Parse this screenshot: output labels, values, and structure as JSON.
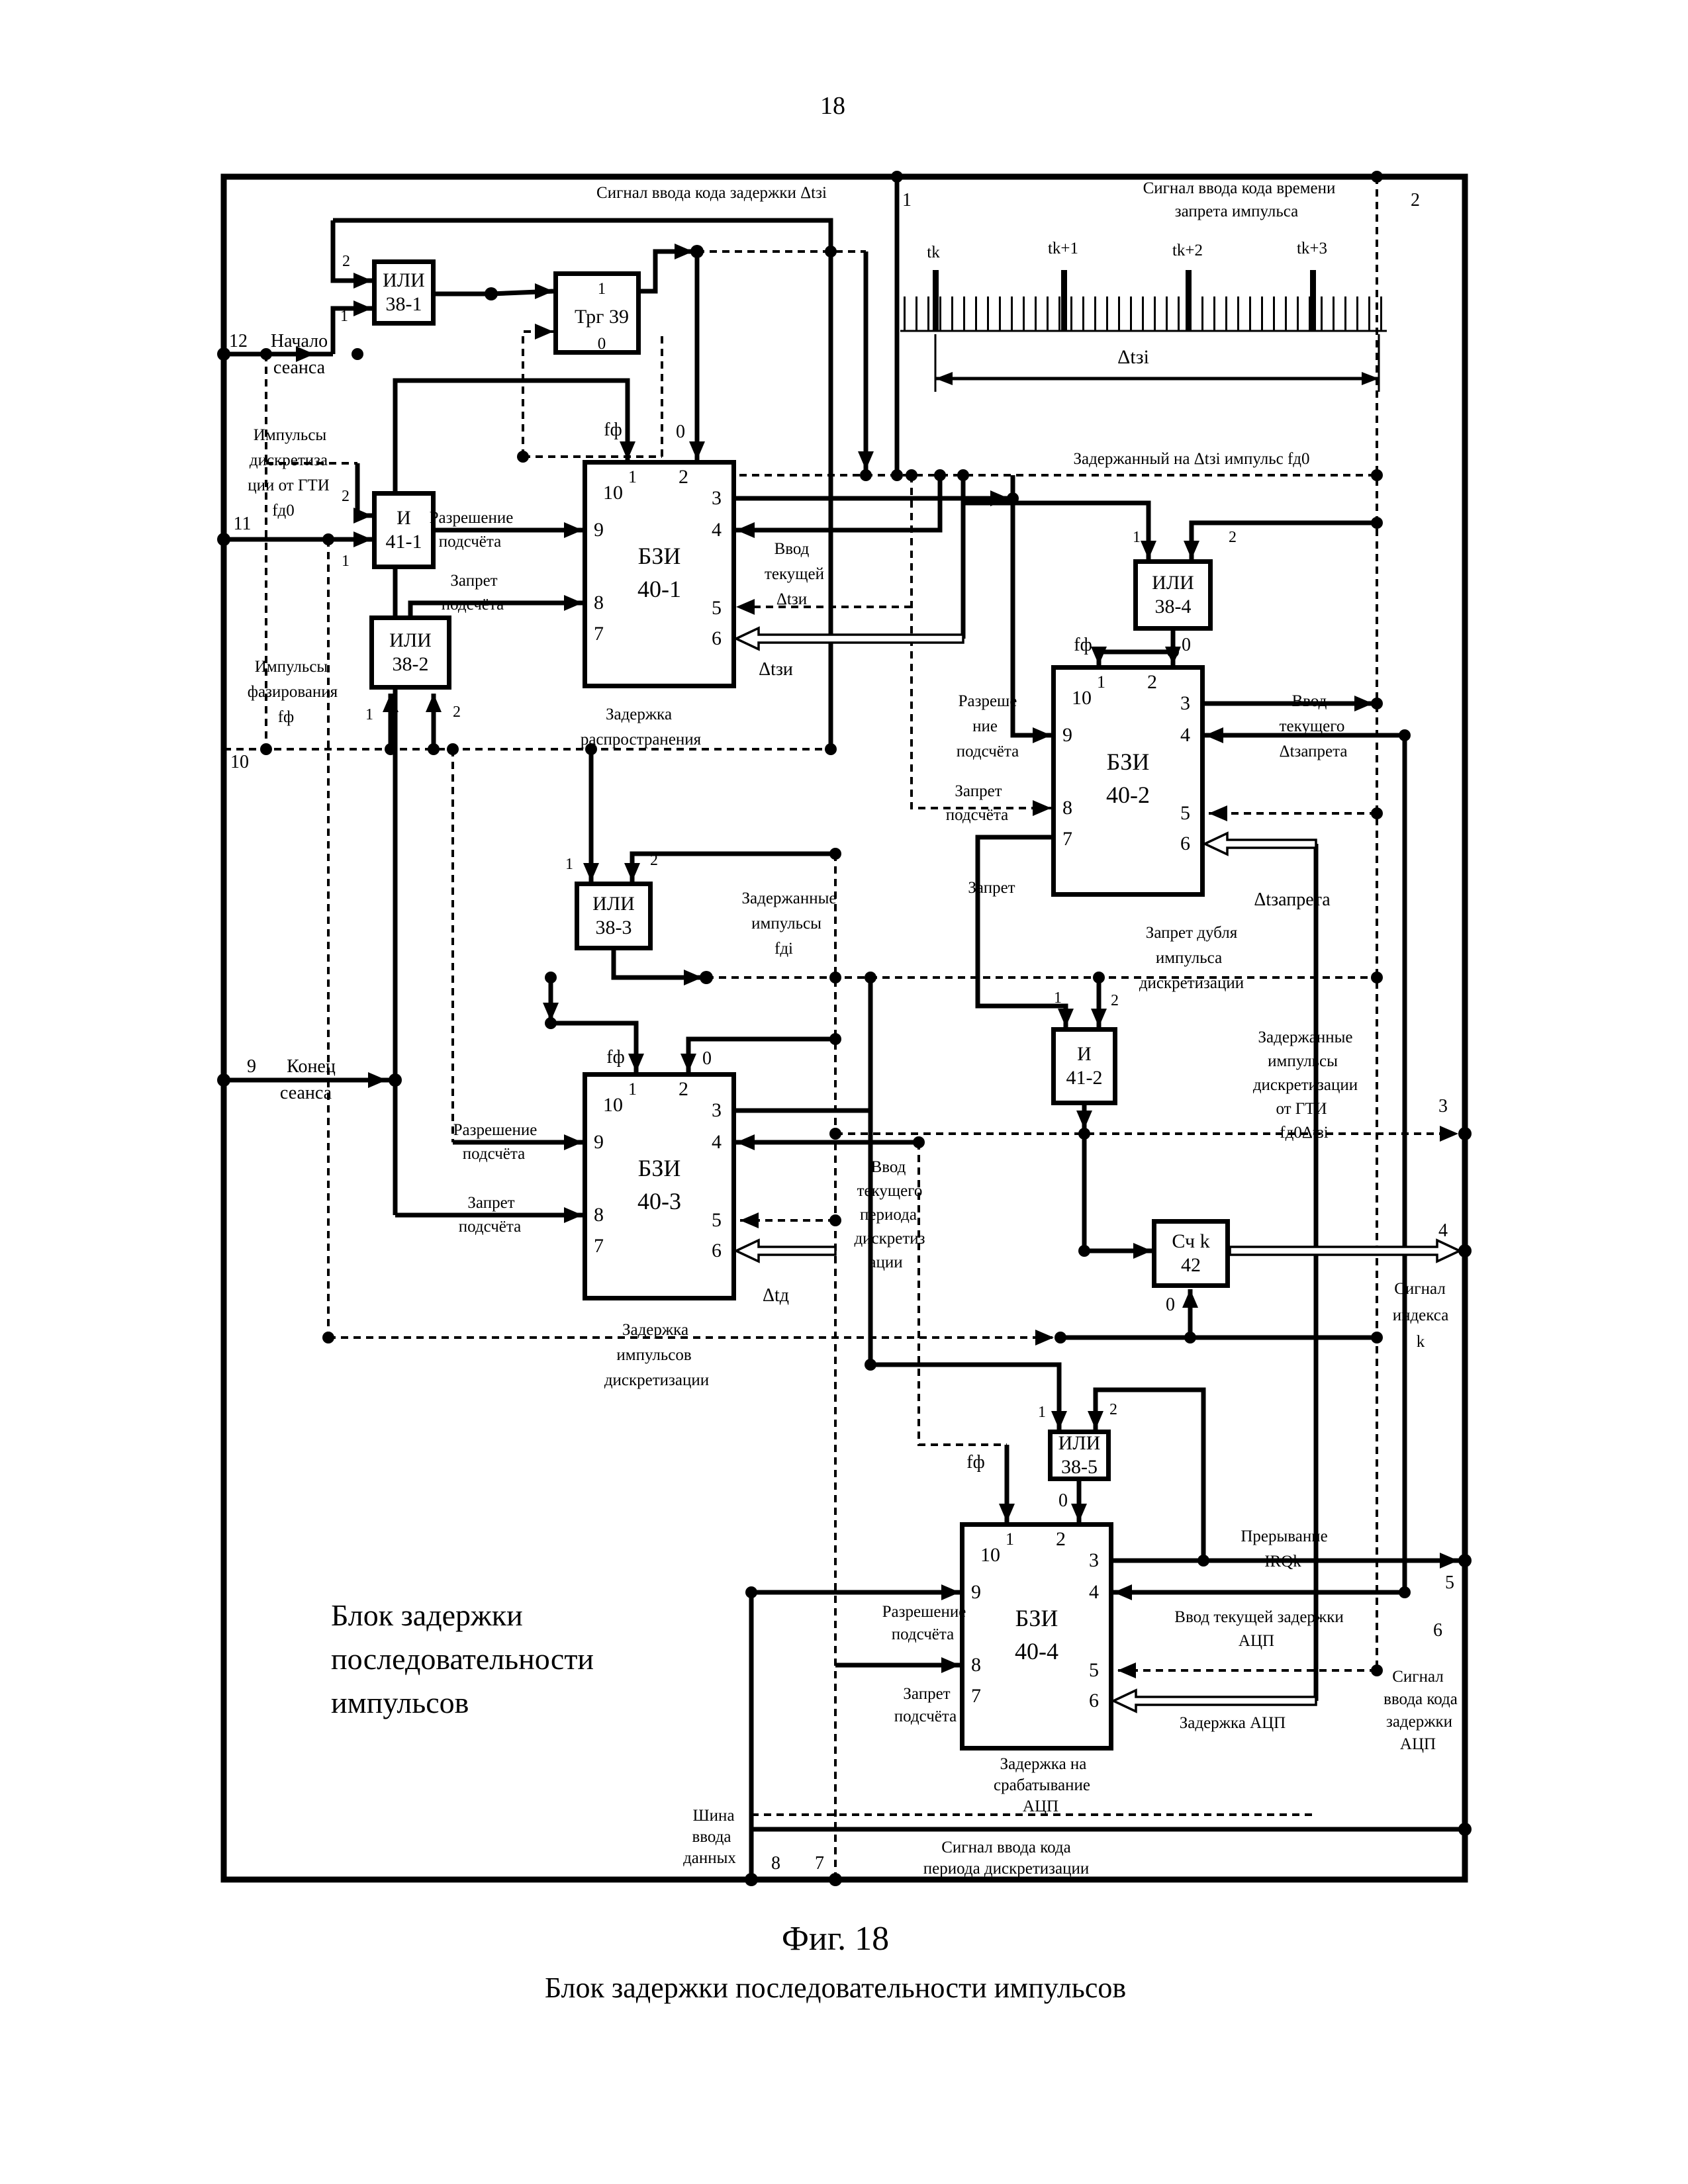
{
  "page_number": "18",
  "header": {
    "delay_code": "Сигнал ввода кода задержки Δtзi",
    "inhibit1": "Сигнал ввода кода времени",
    "inhibit2": "запрета импульса",
    "delayed_pulse": "Задержанный на Δtзi импульс fд0"
  },
  "timing": {
    "t0": "tk",
    "t1": "tk+1",
    "t2": "tk+2",
    "t3": "tk+3",
    "delta": "Δtзi"
  },
  "ports": {
    "p1": "1",
    "p2": "2",
    "p3": "3",
    "p4": "4",
    "p5": "5",
    "p6": "6",
    "p7": "7",
    "p8": "8",
    "p9": "9",
    "p10": "10",
    "p11": "11",
    "p12": "12"
  },
  "pins": {
    "n0": "0",
    "n1": "1",
    "n2": "2",
    "n3": "3",
    "n4": "4",
    "n5": "5",
    "n6": "6",
    "n7": "7",
    "n8": "8",
    "n9": "9",
    "n10": "10",
    "ff": "fф"
  },
  "gates": {
    "or": "ИЛИ",
    "and": "И",
    "g381": "38-1",
    "g382": "38-2",
    "g383": "38-3",
    "g384": "38-4",
    "g385": "38-5",
    "g411": "41-1",
    "g412": "41-2"
  },
  "trg": {
    "set": "1",
    "name": "Трг 39",
    "reset": "0"
  },
  "counter": {
    "name": "Сч k",
    "num": "42"
  },
  "bzi": {
    "name": "БЗИ",
    "b1": "40-1",
    "b2": "40-2",
    "b3": "40-3",
    "b4": "40-4"
  },
  "labels": {
    "start1": "Начало",
    "start2": "сеанса",
    "end1": "Конец",
    "end2": "сеанса",
    "impd1": "Импульсы",
    "impd2": "дискретиза",
    "impd3": "ции от ГТИ",
    "impd4": "fд0",
    "impf1": "Импульсы",
    "impf2": "фазирования",
    "impf3": "fф",
    "razr1": "Разрешение",
    "razr2": "подсчёта",
    "zapr1": "Запрет",
    "zapr2": "подсчёта",
    "razrb2a": "Разреше",
    "razrb2b": "ние",
    "razrb2c": "подсчёта",
    "zapret": "Запрет",
    "vvod1": "Ввод",
    "vvod2": "текущей",
    "vvod3": "Δtзи",
    "dtzi": "Δtзи",
    "zrasp1": "Задержка",
    "zrasp2": "распространения",
    "vz1": "Ввод",
    "vz2": "текущего",
    "vz3": "Δtзапрета",
    "dtzap": "Δtзапрета",
    "zd1": "Запрет дубля",
    "zd2": "импульса",
    "zd3": "дискретизации",
    "zi1": "Задержанные",
    "zi2": "импульсы",
    "zi3": "fдi",
    "zg1": "Задержанные",
    "zg2": "импульсы",
    "zg3": "дискретизации",
    "zg4": "от ГТИ",
    "zg5": "fд0Δtзi",
    "vp1": "Ввод",
    "vp2": "текущего",
    "vp3": "периода",
    "vp4": "дискретиз",
    "vp5": "ации",
    "zid1": "Задержка",
    "zid2": "импульсов",
    "zid3": "дискретизации",
    "dtd": "Δtд",
    "si1": "Сигнал",
    "si2": "индекса",
    "si3": "k",
    "irq1": "Прерывание",
    "irq2": "IRQk",
    "va1": "Ввод текущей задержки",
    "va2": "АЦП",
    "za": "Задержка АЦП",
    "zs1": "Задержка на",
    "zs2": "срабатывание",
    "zs3": "АЦП",
    "sa1": "Сигнал",
    "sa2": "ввода кода",
    "sa3": "задержки",
    "sa4": "АЦП",
    "sh1": "Шина",
    "sh2": "ввода",
    "sh3": "данных",
    "sp1": "Сигнал ввода кода",
    "sp2": "периода дискретизации",
    "bt1": "Блок задержки",
    "bt2": "последовательности",
    "bt3": "импульсов"
  },
  "caption": {
    "fig": "Фиг. 18",
    "title": "Блок задержки последовательности импульсов"
  }
}
